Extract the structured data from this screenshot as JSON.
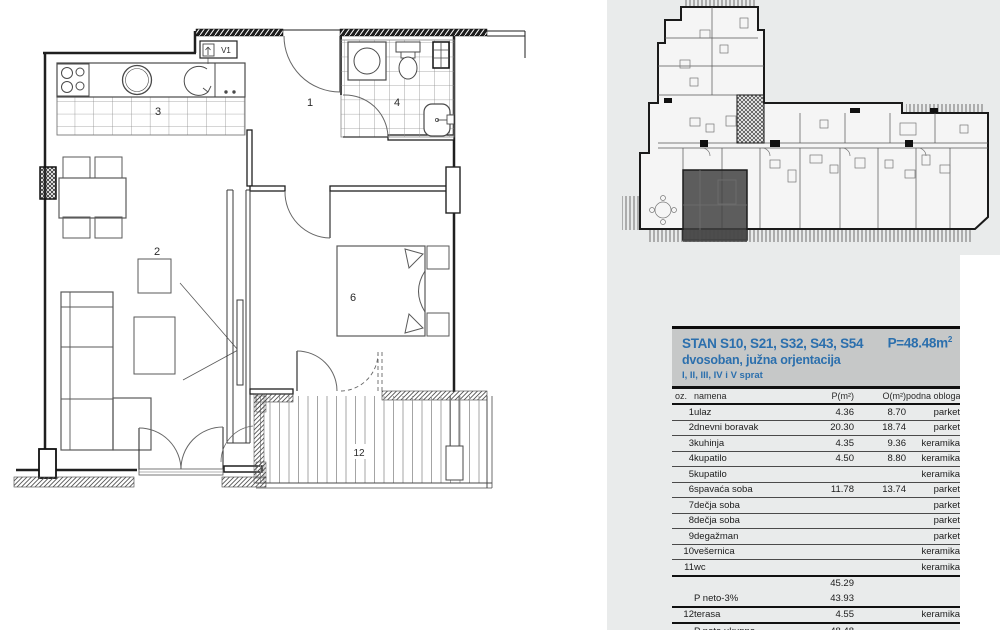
{
  "colors": {
    "accent_blue": "#2b6fad",
    "header_bg": "#c6c8c8",
    "panel_bg": "#e9ebeb"
  },
  "floorplan": {
    "labels": {
      "hall": "1",
      "living": "2",
      "kitchen": "3",
      "bath": "4",
      "bedroom": "6",
      "terrace": "12",
      "vent": "V1"
    }
  },
  "header": {
    "title": "STAN S10, S21, S32, S43, S54",
    "area_value": "P=48.48m",
    "area_sup": "2",
    "subtitle": "dvosoban, južna orjentacija",
    "floors": "I, II, III, IV i V sprat"
  },
  "table": {
    "columns": {
      "oz": "oz.",
      "namena": "namena",
      "p": "P(m²)",
      "o": "O(m²)",
      "obloga": "podna obloga"
    },
    "rows": [
      {
        "oz": "1",
        "namena": "ulaz",
        "p": "4.36",
        "o": "8.70",
        "obloga": "parket"
      },
      {
        "oz": "2",
        "namena": "dnevni boravak",
        "p": "20.30",
        "o": "18.74",
        "obloga": "parket"
      },
      {
        "oz": "3",
        "namena": "kuhinja",
        "p": "4.35",
        "o": "9.36",
        "obloga": "keramika"
      },
      {
        "oz": "4",
        "namena": "kupatilo",
        "p": "4.50",
        "o": "8.80",
        "obloga": "keramika"
      },
      {
        "oz": "5",
        "namena": "kupatilo",
        "p": "",
        "o": "",
        "obloga": "keramika"
      },
      {
        "oz": "6",
        "namena": "spavaća soba",
        "p": "11.78",
        "o": "13.74",
        "obloga": "parket"
      },
      {
        "oz": "7",
        "namena": "dečja soba",
        "p": "",
        "o": "",
        "obloga": "parket"
      },
      {
        "oz": "8",
        "namena": "dečja soba",
        "p": "",
        "o": "",
        "obloga": "parket"
      },
      {
        "oz": "9",
        "namena": "degažman",
        "p": "",
        "o": "",
        "obloga": "parket"
      },
      {
        "oz": "10",
        "namena": "vešernica",
        "p": "",
        "o": "",
        "obloga": "keramika"
      },
      {
        "oz": "11",
        "namena": "wc",
        "p": "",
        "o": "",
        "obloga": "keramika"
      }
    ],
    "subtotal_p": "45.29",
    "neto3": {
      "label": "P neto-3%",
      "p": "43.93"
    },
    "terasa": {
      "oz": "12",
      "namena": "terasa",
      "p": "4.55",
      "o": "",
      "obloga": "keramika"
    },
    "total": {
      "label": "P neto ukupno",
      "p": "48.48"
    }
  }
}
